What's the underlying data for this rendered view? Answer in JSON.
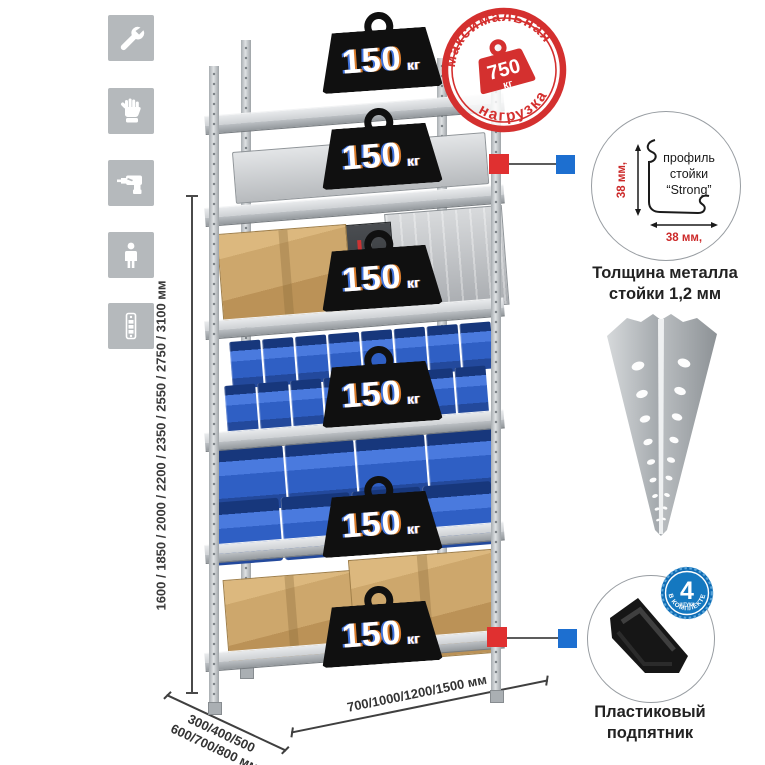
{
  "colors": {
    "accent_red": "#d4302f",
    "accent_blue": "#1d6fd0",
    "bin_blue": "#2f5fc4",
    "metal_gray": "#ccd0d3",
    "cardboard": "#c9a368",
    "badge_black": "#101010",
    "icon_bg": "#b5b9bc"
  },
  "sidebar_icons": [
    {
      "name": "wrench"
    },
    {
      "name": "gloves"
    },
    {
      "name": "drill"
    },
    {
      "name": "person"
    },
    {
      "name": "rack-profile"
    }
  ],
  "dimensions": {
    "height_label": "1600 / 1850 / 2000 / 2200 / 2350 / 2550 / 2750 / 3100 мм",
    "depth_line1": "300/400/500",
    "depth_line2": "600/700/800 мм",
    "width_label": "700/1000/1200/1500 мм"
  },
  "rack": {
    "shelves": [
      {
        "load": "150",
        "unit": "кг"
      },
      {
        "load": "150",
        "unit": "кг"
      },
      {
        "load": "150",
        "unit": "кг"
      },
      {
        "load": "150",
        "unit": "кг"
      },
      {
        "load": "150",
        "unit": "кг"
      },
      {
        "load": "150",
        "unit": "кг"
      }
    ]
  },
  "stamp": {
    "top_text": "максимальная",
    "bottom_text": "нагрузка",
    "weight": "750",
    "unit": "кг"
  },
  "profile_detail": {
    "label_line1": "профиль",
    "label_line2": "стойки",
    "label_line3": "“Strong”",
    "dim_vertical": "38 мм,",
    "dim_horizontal": "38 мм,",
    "caption_line1": "Толщина металла",
    "caption_line2": "стойки 1,2 мм"
  },
  "foot_detail": {
    "badge_number": "4",
    "badge_small": "штуки",
    "badge_arc": "в комплекте",
    "caption_line1": "Пластиковый",
    "caption_line2": "подпятник"
  }
}
